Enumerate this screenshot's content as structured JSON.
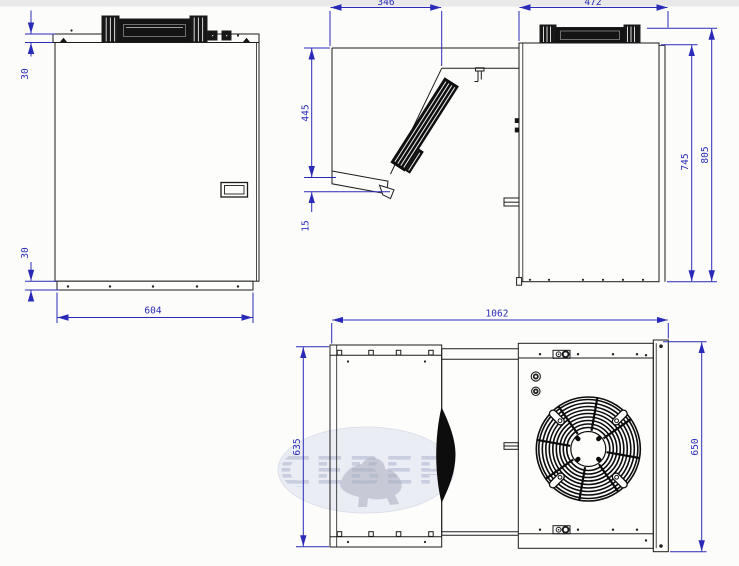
{
  "drawing": {
    "kind": "refrigeration monoblock dimensional drawing",
    "colors": {
      "dimension_blue": "#2a2ab8",
      "line_black": "#1c1c1c"
    }
  },
  "watermark": {
    "text": "СЕВЕР"
  },
  "dims": {
    "front": {
      "flange_top": "30",
      "flange_bottom": "30",
      "width": "604"
    },
    "side": {
      "evap_depth": "346",
      "evap_height": "445",
      "tray_drop": "15",
      "cond_depth": "472",
      "cond_height": "745",
      "total_height": "805"
    },
    "top": {
      "total_length": "1062",
      "evap_width": "635",
      "cond_width": "650"
    }
  }
}
